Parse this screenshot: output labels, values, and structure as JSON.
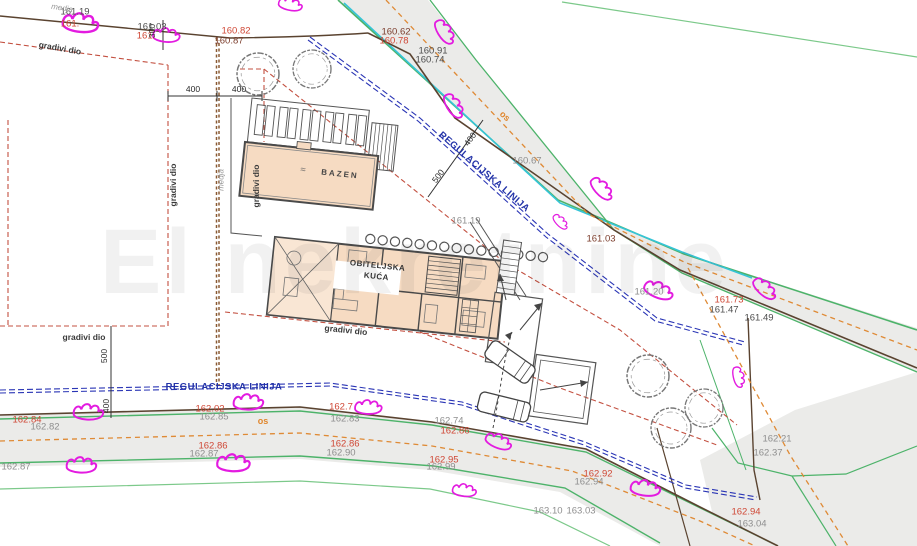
{
  "colors": {
    "road_fill": "#ebebe9",
    "green_line": "#4db36a",
    "cyan_line": "#35c4d7",
    "orange_axis": "#df8a35",
    "red_dashed": "#c35040",
    "blue_regulation": "#2a35b5",
    "boundary_brown": "#5a4330",
    "parcel_fill": "#f6dbc2",
    "survey_mark_magenta": "#e31be0",
    "elevation_red": "#cf4735",
    "elevation_gray": "#8e8e8e"
  },
  "labels": {
    "elevations": [
      "161.19",
      "161.",
      "161.03",
      "161.",
      "160.82",
      "160.87",
      "160.62",
      "160.78",
      "160.91",
      "160.74",
      "160.67",
      "161.19",
      "161.03",
      "161.20",
      "161.73",
      "161.47",
      "161.49",
      "162.21",
      "162.37",
      "162.84",
      "162.82",
      "162.02",
      "162.85",
      "162.7",
      "162.83",
      "162.74",
      "162.86",
      "162.86",
      "162.90",
      "162.95",
      "162.99",
      "162.92",
      "162.94",
      "163.10",
      "163.03",
      "162.94",
      "163.04",
      "162.86",
      "162.87",
      "162.87"
    ],
    "dimensions": [
      "300",
      "400",
      "400",
      "400",
      "500",
      "500",
      "400"
    ],
    "regulation_line": "REGULACIJSKA LINIJA",
    "road_axis": "os",
    "boundary": "medja",
    "buildable_area": "gradivi dio",
    "house_line1": "OBITELJSKA",
    "house_line2": "KUĆA",
    "pool": "BAZEN",
    "water_symbol": "≈",
    "watermark": "El nekretnine"
  }
}
